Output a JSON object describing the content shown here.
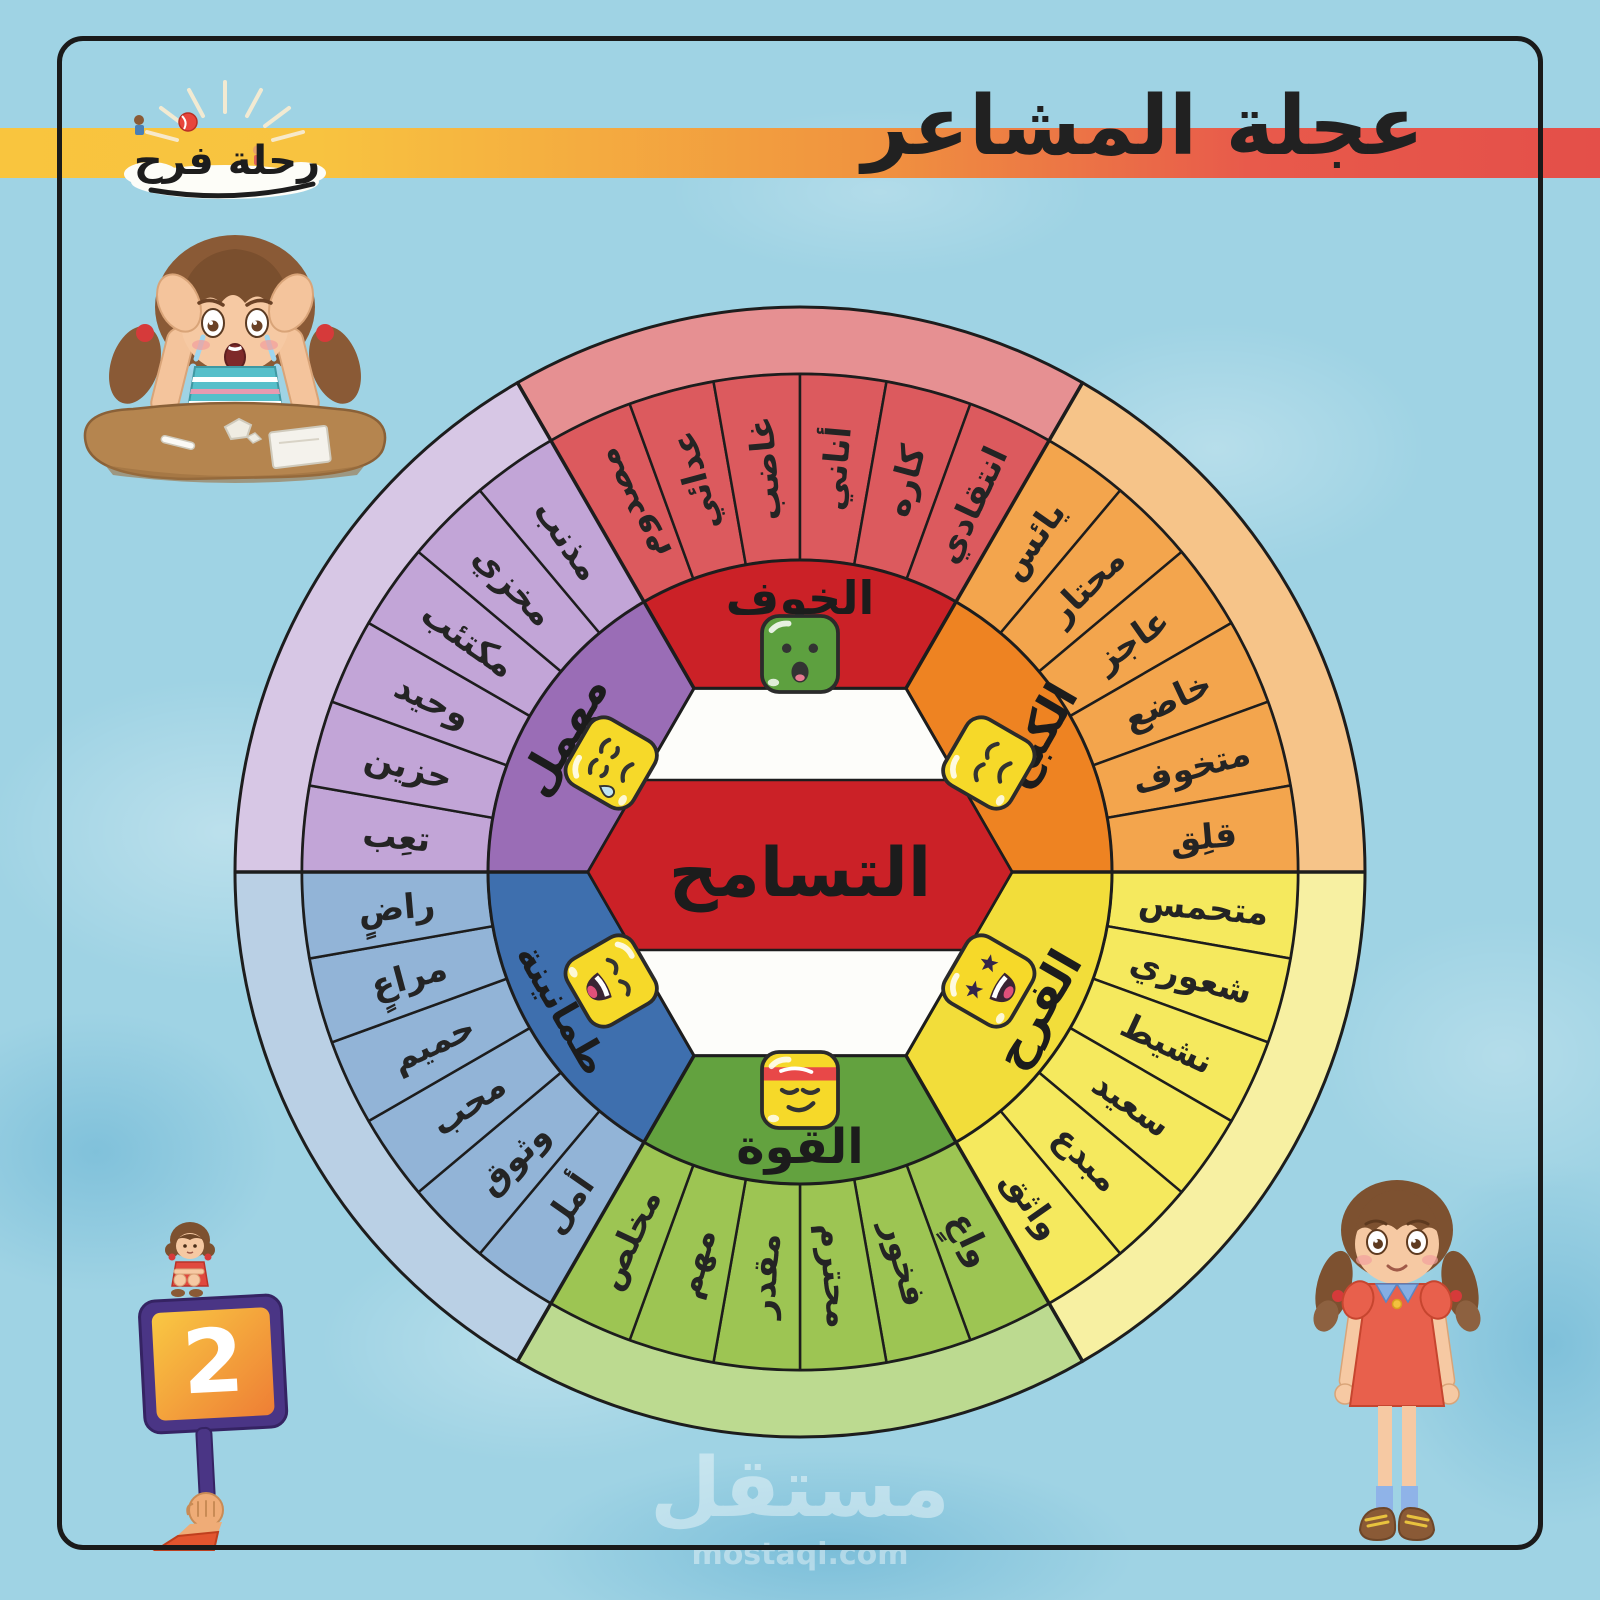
{
  "header": {
    "title": "عجلة المشاعر",
    "logo": {
      "text": "رحلة فرح",
      "icons": [
        "sun-rays-icon",
        "cloud-icon",
        "beach-ball-icon"
      ]
    }
  },
  "palette": {
    "background": "#9fd3e4",
    "band_gradient": [
      "#f9c53e",
      "#f0923f",
      "#e44f49"
    ],
    "frame": "#1a1a1a",
    "outline": "#1d1d1d"
  },
  "wheel": {
    "center_label": "التسامح",
    "center_fill": "#fdfdfa",
    "center_band": "#cb2127",
    "sectors": [
      {
        "id": "fear",
        "label": "الخوف",
        "emoji": "scared-face-icon",
        "a0": 120,
        "label_rotation": 0,
        "label_size": 46,
        "colors": {
          "core": "#cb2127",
          "wedge": "#dc5a5e",
          "rim": "#e69092",
          "emoji_fill": "#5da03f"
        },
        "words": [
          "مصدوم",
          "عدائي",
          "غاضب",
          "أناني",
          "كاره",
          "انتقادي"
        ]
      },
      {
        "id": "restraint",
        "label": "الكبح",
        "emoji": "angry-face-icon",
        "a0": 60,
        "label_rotation": -60,
        "label_size": 46,
        "colors": {
          "core": "#ee8322",
          "wedge": "#f3a54d",
          "rim": "#f6c489",
          "emoji_fill": "#f6d929"
        },
        "words": [
          "يائس",
          "محتار",
          "عاجز",
          "خاضع",
          "متخوف",
          "قلِق"
        ]
      },
      {
        "id": "joy",
        "label": "الفرح",
        "emoji": "starstruck-face-icon",
        "a0": 0,
        "label_rotation": -60,
        "label_size": 46,
        "colors": {
          "core": "#f2dd3a",
          "wedge": "#f5e95e",
          "rim": "#f7f0a2",
          "emoji_fill": "#f6d929"
        },
        "words": [
          "متحمس",
          "شعوري",
          "نشيط",
          "سعيد",
          "مبدع",
          "واثق"
        ]
      },
      {
        "id": "strength",
        "label": "القوة",
        "emoji": "determined-face-icon",
        "a0": -60,
        "label_rotation": 0,
        "label_size": 48,
        "colors": {
          "core": "#63a23f",
          "wedge": "#9dc553",
          "rim": "#bcda90",
          "emoji_fill": "#f6d929"
        },
        "words": [
          "واعٍ",
          "فخور",
          "محترم",
          "مقدر",
          "مهم",
          "مخلص"
        ]
      },
      {
        "id": "serenity",
        "label": "طمأنينة",
        "emoji": "laughing-face-icon",
        "a0": -120,
        "label_rotation": 60,
        "label_size": 38,
        "colors": {
          "core": "#3e6fae",
          "wedge": "#92b4d7",
          "rim": "#bad0e5",
          "emoji_fill": "#f6d929"
        },
        "words": [
          "أمل",
          "وثوق",
          "محب",
          "حميم",
          "مراعٍ",
          "راضٍ"
        ]
      },
      {
        "id": "neglected",
        "label": "مهمل",
        "emoji": "sad-tear-face-icon",
        "a0": 180,
        "label_rotation": -60,
        "label_size": 46,
        "colors": {
          "core": "#9a6db6",
          "wedge": "#c2a5d7",
          "rim": "#d7c7e5",
          "emoji_fill": "#f6d929"
        },
        "words": [
          "تعِب",
          "حزين",
          "وحيد",
          "مكتئب",
          "مخزي",
          "مذنب"
        ]
      }
    ]
  },
  "badge": {
    "number": "2"
  },
  "watermark": {
    "name": "مستقل",
    "domain": "mostaql.com"
  },
  "illustrations": {
    "top_left": "crying-girl-at-desk",
    "bottom_left": "hand-holding-number-sign",
    "bottom_right": "standing-girl"
  }
}
